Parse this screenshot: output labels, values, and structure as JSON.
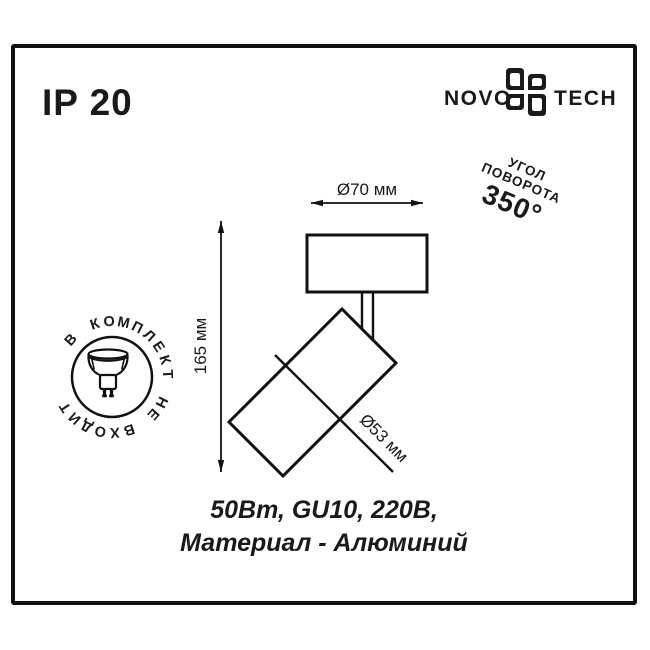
{
  "badge": {
    "ip_rating": "IP 20"
  },
  "logo": {
    "left": "NOVO",
    "right": "TECH",
    "flower_icon": "novotech-flower-icon",
    "color": "#1a1a1a"
  },
  "rotation_note": {
    "line1": "УГОЛ",
    "line2": "ПОВОРОТА",
    "value": "350°"
  },
  "stamp": {
    "ring_text": "В КОМПЛЕКТ НЕ ВХОДИТ",
    "lamp_icon": "gu10-lamp-icon"
  },
  "drawing": {
    "dim_width": "Ø70 мм",
    "dim_height": "165 мм",
    "dim_head": "Ø53 мм"
  },
  "specs": {
    "line1": "50Вт, GU10, 220В,",
    "line2": "Материал - Алюминий"
  },
  "colors": {
    "ink": "#1a1a1a",
    "background": "#ffffff"
  }
}
